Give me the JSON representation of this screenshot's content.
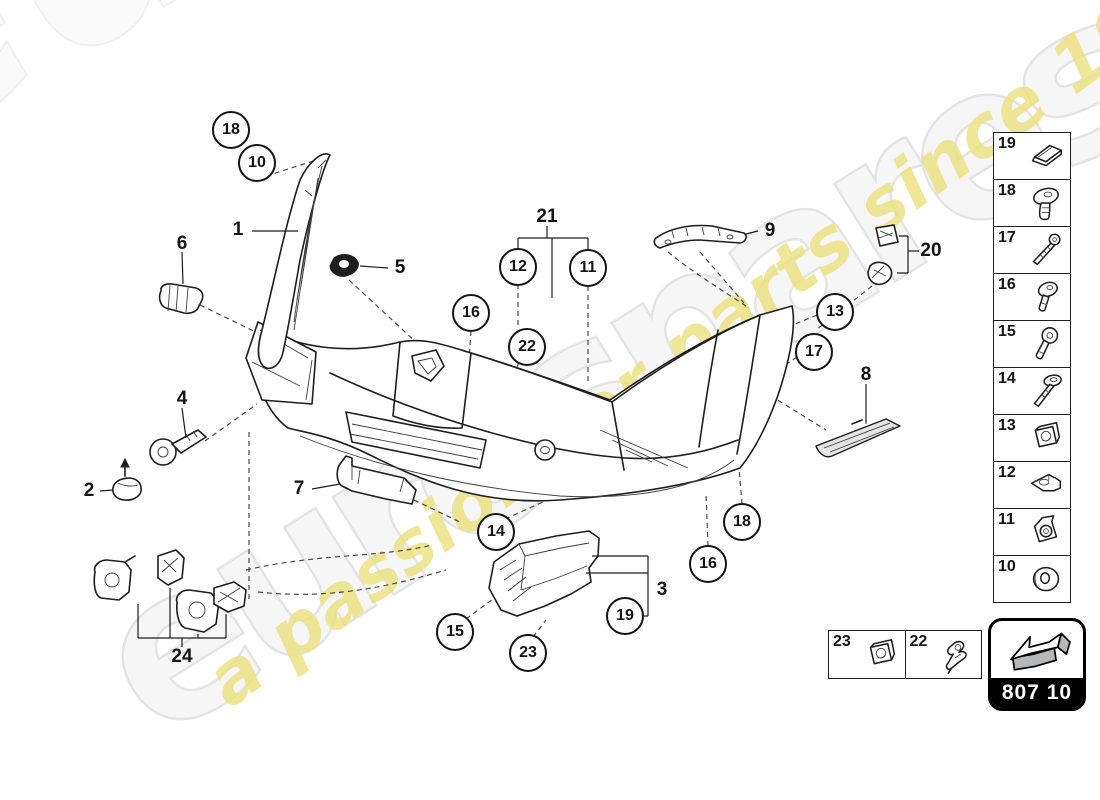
{
  "watermark": {
    "brand": "eurospares",
    "tagline": "a passion for parts since 1985",
    "brand_color": "#f6f6f6",
    "tagline_color": "#ece27d"
  },
  "part_code_badge": {
    "code": "807 10"
  },
  "diagram": {
    "circle_callouts": [
      {
        "label": "18",
        "x": 231,
        "y": 130
      },
      {
        "label": "10",
        "x": 257,
        "y": 163
      },
      {
        "label": "12",
        "x": 518,
        "y": 267
      },
      {
        "label": "11",
        "x": 588,
        "y": 268
      },
      {
        "label": "16",
        "x": 471,
        "y": 313
      },
      {
        "label": "22",
        "x": 527,
        "y": 347
      },
      {
        "label": "13",
        "x": 835,
        "y": 312
      },
      {
        "label": "17",
        "x": 814,
        "y": 352
      },
      {
        "label": "14",
        "x": 496,
        "y": 532
      },
      {
        "label": "18",
        "x": 742,
        "y": 522
      },
      {
        "label": "16",
        "x": 708,
        "y": 564
      },
      {
        "label": "19",
        "x": 625,
        "y": 616
      },
      {
        "label": "15",
        "x": 455,
        "y": 632
      },
      {
        "label": "23",
        "x": 528,
        "y": 653
      }
    ],
    "text_callouts": [
      {
        "label": "1",
        "x": 238,
        "y": 230
      },
      {
        "label": "6",
        "x": 182,
        "y": 244
      },
      {
        "label": "5",
        "x": 400,
        "y": 268
      },
      {
        "label": "21",
        "x": 547,
        "y": 217
      },
      {
        "label": "9",
        "x": 770,
        "y": 231
      },
      {
        "label": "20",
        "x": 931,
        "y": 251
      },
      {
        "label": "8",
        "x": 866,
        "y": 375
      },
      {
        "label": "4",
        "x": 182,
        "y": 399
      },
      {
        "label": "2",
        "x": 89,
        "y": 491
      },
      {
        "label": "7",
        "x": 299,
        "y": 489
      },
      {
        "label": "3",
        "x": 662,
        "y": 590
      },
      {
        "label": "24",
        "x": 182,
        "y": 657
      }
    ]
  },
  "sidebar": {
    "items": [
      {
        "number": "19",
        "icon": "shim-plate-icon"
      },
      {
        "number": "18",
        "icon": "dome-head-rivet-icon"
      },
      {
        "number": "17",
        "icon": "long-screw-icon"
      },
      {
        "number": "16",
        "icon": "oval-head-screw-icon"
      },
      {
        "number": "15",
        "icon": "pan-head-screw-icon"
      },
      {
        "number": "14",
        "icon": "washer-head-screw-icon"
      },
      {
        "number": "13",
        "icon": "cage-nut-icon"
      },
      {
        "number": "12",
        "icon": "flat-clip-icon"
      },
      {
        "number": "11",
        "icon": "clip-nut-icon"
      },
      {
        "number": "10",
        "icon": "grommet-washer-icon"
      }
    ]
  },
  "bottom_box": {
    "items": [
      {
        "number": "23",
        "icon": "cage-nut-icon"
      },
      {
        "number": "22",
        "icon": "sensor-bracket-icon"
      }
    ]
  }
}
